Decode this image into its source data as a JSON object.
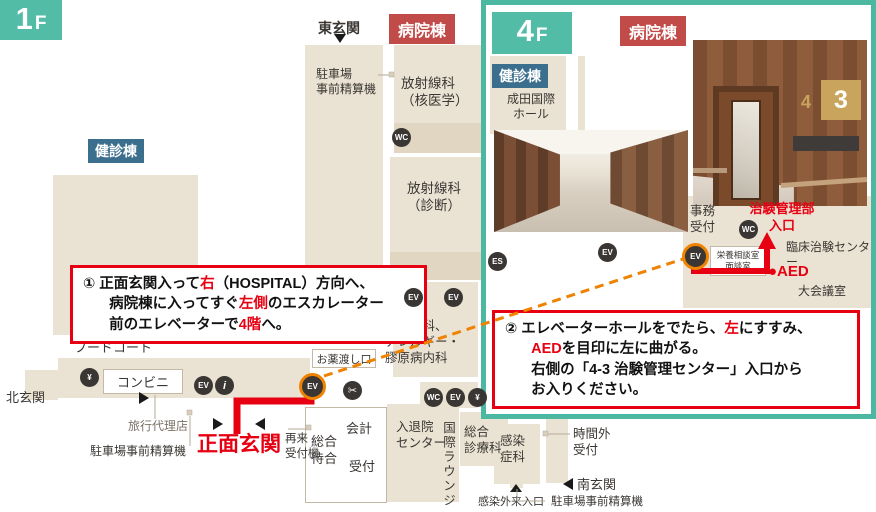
{
  "colors": {
    "red": "#e60012",
    "orange": "#ef8200",
    "teal": "#53bca6",
    "tealborder": "#4cb8a2",
    "navy": "#3c6f8e",
    "tagred": "#c14b49",
    "beige": "#eae3d3",
    "beige2": "#e0d6c2",
    "ink": "#3a3633"
  },
  "icons": {
    "elevator": "EV",
    "restroom": "WC",
    "info": "i",
    "atm": "¥",
    "salon": "✂",
    "escalator": "ES"
  },
  "floor1": {
    "floor_num": "1",
    "floor_suffix": "F",
    "building_hospital": "病院棟",
    "building_checkup": "健診棟",
    "east_entrance": "東玄関",
    "north_entrance": "北玄関",
    "south_entrance": "南玄関",
    "parking_pay_top": "駐車場\n事前精算機",
    "radiology_nuclear": "放射線科\n（核医学）",
    "radiology_diag": "放射線科\n（診断）",
    "plastic_allergy": "形成外科、\nアレルギー・\n膠原病内科",
    "medicine_window": "お薬渡し口",
    "food_court": "フードコート",
    "convenience": "コンビニ",
    "travel_agency": "旅行代理店",
    "parking_pay_west": "駐車場事前精算機",
    "main_entrance": "正面玄関",
    "return_machine": "再来\n受付機",
    "waiting": "総合\n待合",
    "accounting": "会計",
    "reception": "受付",
    "admission_center": "入退院\nセンター",
    "intl_lounge": "国際ラウンジ",
    "general_medicine": "総合\n診療科",
    "infectious": "感染\n症科",
    "after_hours": "時間外\n受付",
    "parking_pay_south": "駐車場事前精算機",
    "infection_entrance": "感染外来入口",
    "instruction": [
      {
        "t": "① 正面玄関入って"
      },
      {
        "t": "右",
        "r": 1
      },
      {
        "t": "（HOSPITAL）方向へ、\n病院棟に入ってすぐ"
      },
      {
        "t": "左側",
        "r": 1
      },
      {
        "t": "のエスカレーター\n前のエレベーターで"
      },
      {
        "t": "4階",
        "r": 1
      },
      {
        "t": "へ。"
      }
    ]
  },
  "floor4": {
    "floor_num": "4",
    "floor_suffix": "F",
    "building_hospital": "病院棟",
    "building_checkup": "健診棟",
    "narita_hall": "成田国際\nホール",
    "office_reception": "事務\n受付",
    "trial_dept": "治験管理部\n入口",
    "nutrition_room": "栄養相談室\n面談室",
    "clinical_center": "臨床治験センター",
    "aed": "●AED",
    "conference": "大会議室",
    "door_sign_num4": "4",
    "door_sign_num3": "3",
    "instruction": [
      {
        "t": "② エレベーターホールをでたら、"
      },
      {
        "t": "左",
        "r": 1
      },
      {
        "t": "にすすみ、\n"
      },
      {
        "t": "AED",
        "r": 1
      },
      {
        "t": "を目印に左に曲がる。\n右側の「4-3 治験管理センター」入口から\nお入りください。"
      }
    ]
  }
}
